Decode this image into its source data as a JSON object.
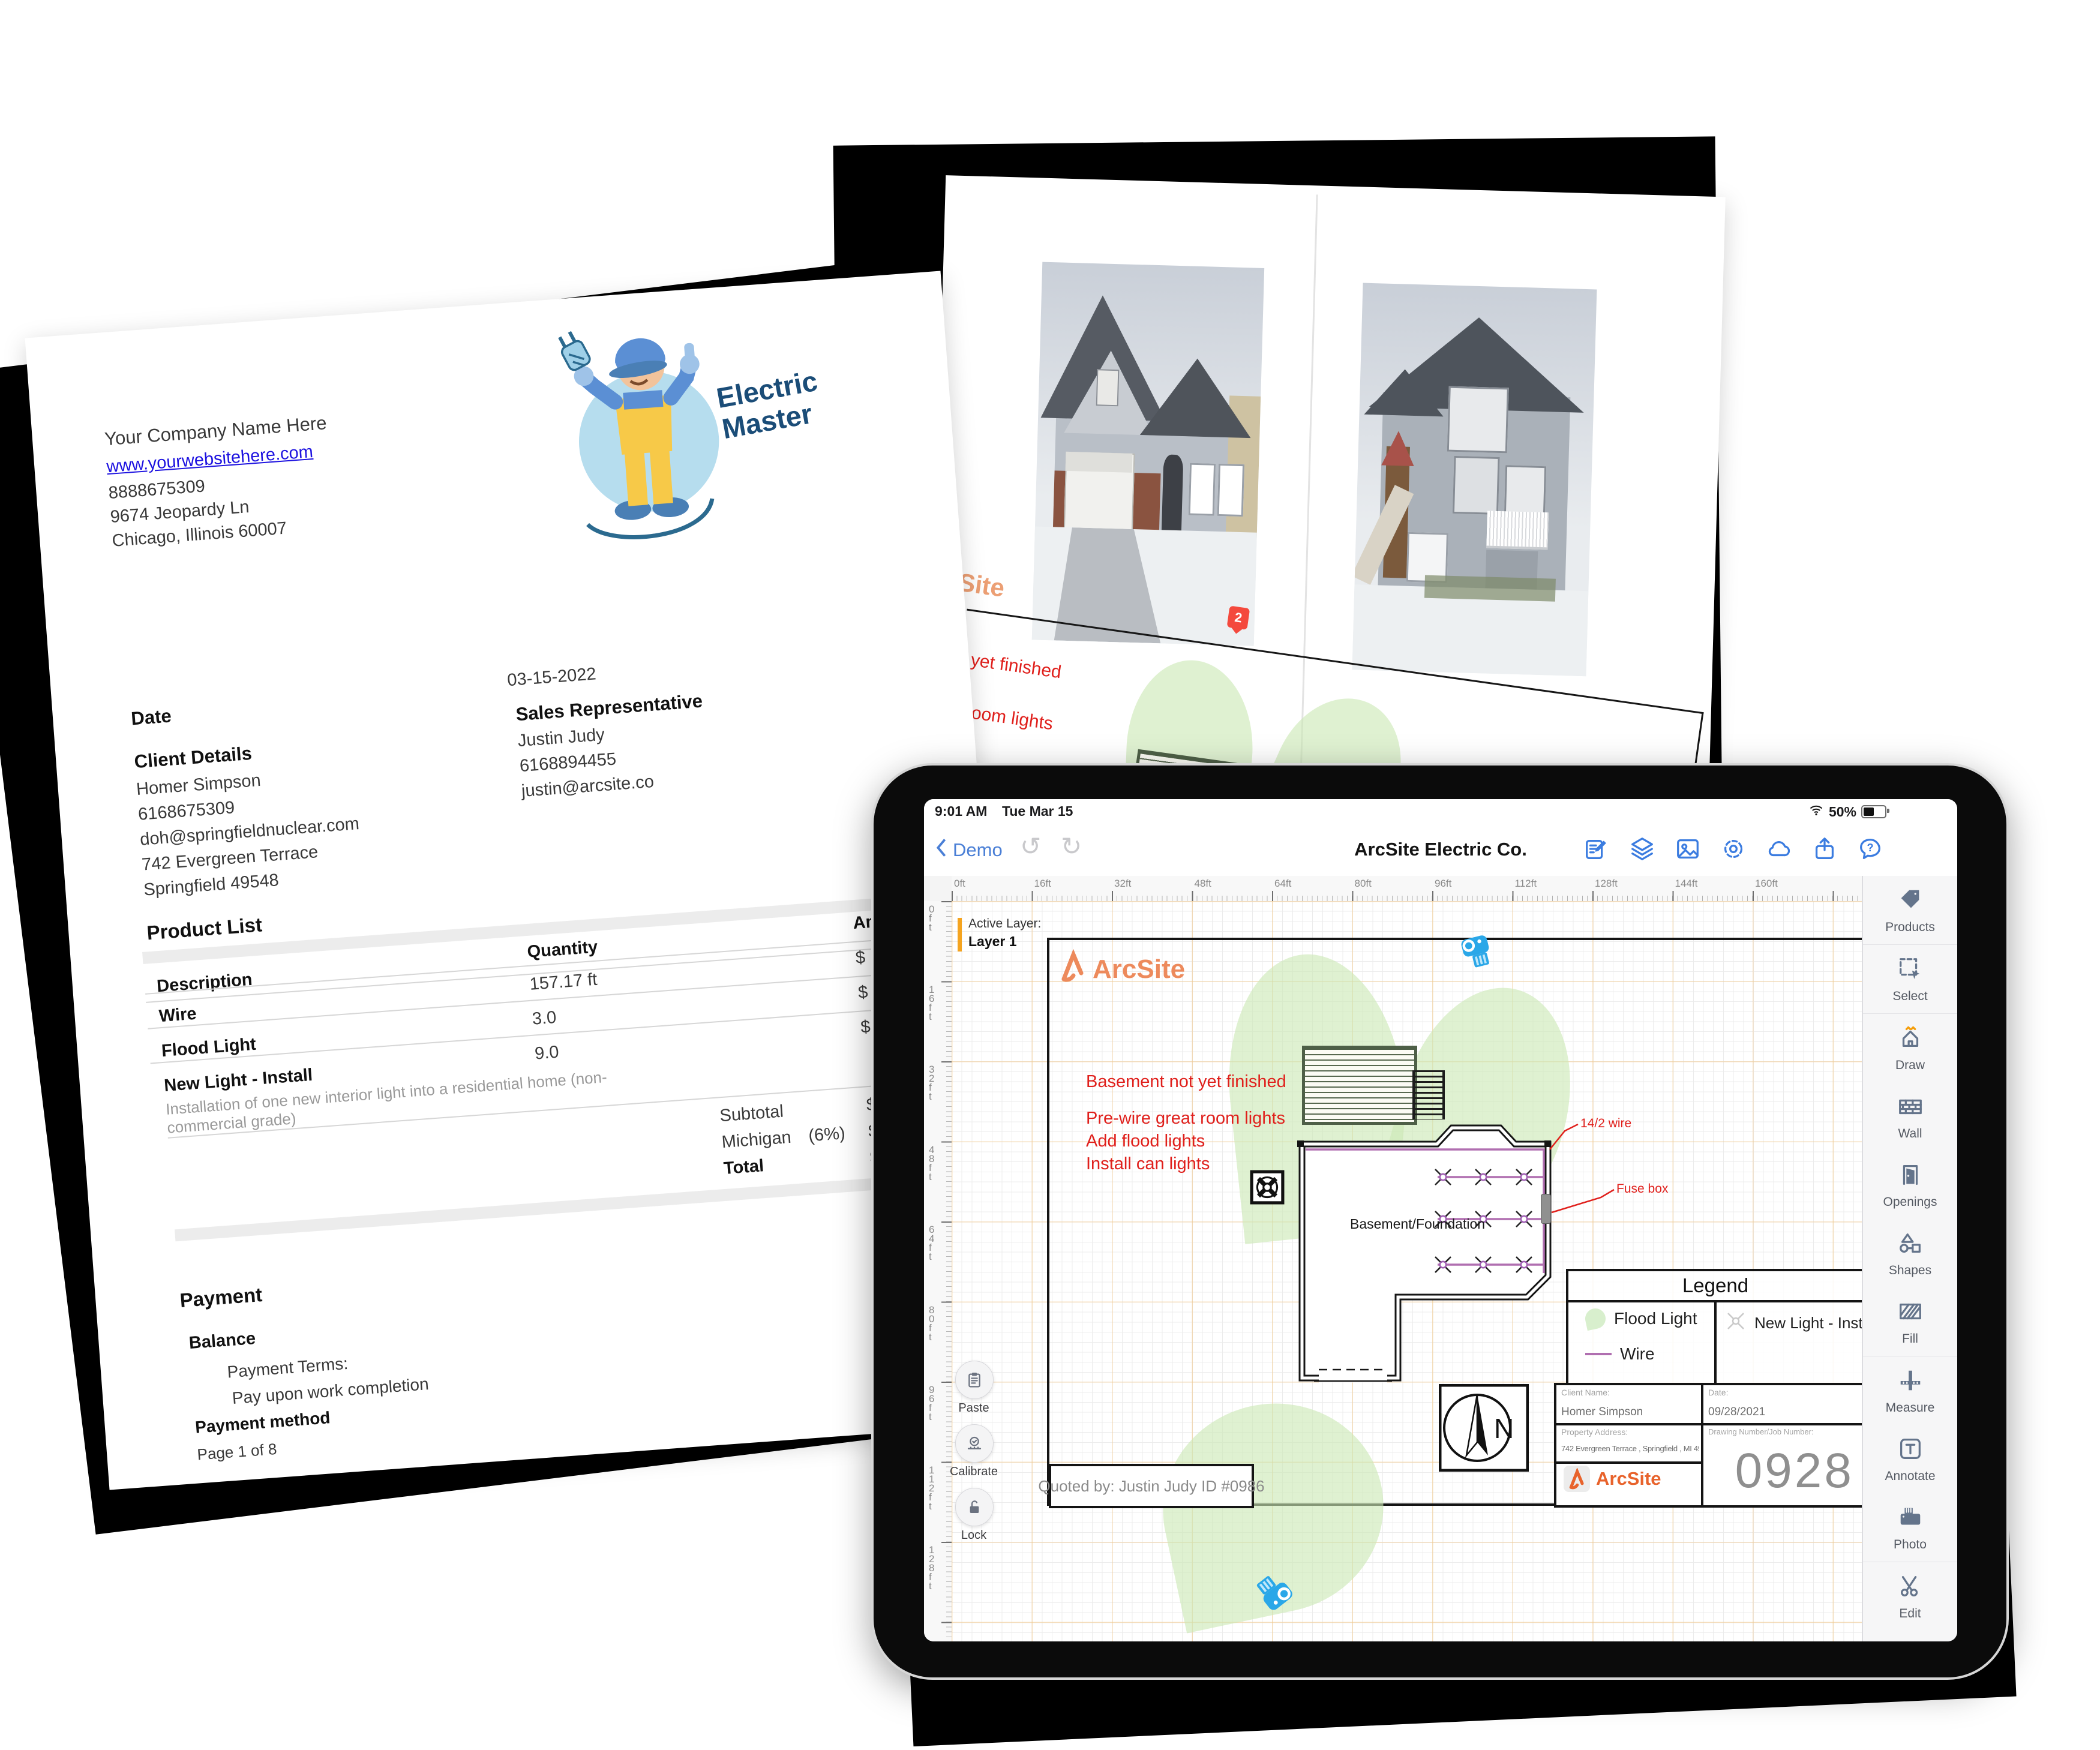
{
  "invoice": {
    "company": {
      "name": "Your Company Name Here",
      "website": "www.yourwebsitehere.com",
      "phone": "8888675309",
      "address1": "9674 Jeopardy Ln",
      "address2": "Chicago, Illinois 60007"
    },
    "logo": {
      "line1": "Electric",
      "line2": "Master"
    },
    "date_label": "Date",
    "date_value": "03-15-2022",
    "client": {
      "heading": "Client Details",
      "name": "Homer Simpson",
      "phone": "6168675309",
      "email": "doh@springfieldnuclear.com",
      "address1": "742 Evergreen Terrace",
      "address2": "Springfield 49548"
    },
    "sales_rep": {
      "heading": "Sales Representative",
      "name": "Justin Judy",
      "phone": "6168894455",
      "email": "justin@arcsite.co"
    },
    "product_list": {
      "heading": "Product List",
      "columns": [
        "Description",
        "Quantity",
        "Amount"
      ],
      "rows": [
        {
          "description": "Wire",
          "detail": "",
          "quantity": "157.17 ft",
          "amount": "$"
        },
        {
          "description": "Flood Light",
          "detail": "",
          "quantity": "3.0",
          "amount": "$"
        },
        {
          "description": "New Light - Install",
          "detail": "Installation of one new interior light into a residential home (non-commercial grade)",
          "quantity": "9.0",
          "amount": "$1"
        }
      ],
      "summary": [
        {
          "label": "Subtotal",
          "note": "",
          "amount": "$2"
        },
        {
          "label": "Michigan",
          "note": "(6%)",
          "amount": "$"
        },
        {
          "label": "Total",
          "note": "",
          "amount": "$3"
        }
      ]
    },
    "payment": {
      "heading": "Payment",
      "balance_label": "Balance",
      "terms_label": "Payment Terms:",
      "terms_value": "Pay upon work completion",
      "method_label": "Payment method"
    },
    "page_footer": "Page 1 of 8"
  },
  "photos_page": {
    "photo1_label": "1 - 1",
    "photo2_label": "2 - 1"
  },
  "plan_page": {
    "brand": "ArcSite",
    "pin_label": "2",
    "wire_label": "14/2 wire",
    "notes": [
      "Basement not yet finished",
      "Pre-wire great room lights",
      "Add flood lights",
      "Install can lights"
    ]
  },
  "tablet": {
    "status": {
      "time": "9:01 AM",
      "date": "Tue Mar 15",
      "battery": "50%"
    },
    "nav": {
      "back": "Demo",
      "title": "ArcSite Electric Co."
    },
    "nav_icons": [
      "compose-icon",
      "layers-icon",
      "image-icon",
      "settings-gear-icon",
      "cloud-icon",
      "share-icon",
      "help-chat-icon"
    ],
    "active_layer": {
      "label": "Active Layer:",
      "value": "Layer 1"
    },
    "ruler_h": [
      "0ft",
      "16ft",
      "32ft",
      "48ft",
      "64ft",
      "80ft",
      "96ft",
      "112ft",
      "128ft",
      "144ft",
      "160ft"
    ],
    "ruler_v": [
      "0ft",
      "16ft",
      "32ft",
      "48ft",
      "64ft",
      "80ft",
      "96ft",
      "112ft",
      "128ft"
    ],
    "sidebar": [
      {
        "label": "Products",
        "icon": "products-tag-icon"
      },
      {
        "label": "Select",
        "icon": "select-icon"
      },
      {
        "label": "Draw",
        "icon": "draw-house-icon"
      },
      {
        "label": "Wall",
        "icon": "wall-brick-icon"
      },
      {
        "label": "Openings",
        "icon": "door-opening-icon"
      },
      {
        "label": "Shapes",
        "icon": "shapes-icon"
      },
      {
        "label": "Fill",
        "icon": "fill-hatch-icon"
      },
      {
        "label": "Measure",
        "icon": "measure-ruler-icon"
      },
      {
        "label": "Annotate",
        "icon": "annotate-text-icon"
      },
      {
        "label": "Photo",
        "icon": "camera-icon"
      },
      {
        "label": "Edit",
        "icon": "scissors-icon"
      }
    ],
    "floating_buttons": [
      {
        "label": "Paste",
        "icon": "clipboard-icon"
      },
      {
        "label": "Calibrate",
        "icon": "calibrate-icon"
      },
      {
        "label": "Lock",
        "icon": "unlock-icon"
      }
    ],
    "drawing": {
      "brand": "ArcSite",
      "notes": [
        "Basement not yet finished",
        "Pre-wire great room lights",
        "Add flood lights",
        "Install can lights"
      ],
      "room_label": "Basement/Foundation",
      "wire_label": "14/2 wire",
      "fusebox_label": "Fuse box",
      "legend": {
        "title": "Legend",
        "flood": "Flood Light",
        "wire": "Wire",
        "newlight": "New Light - Install"
      },
      "title_block": {
        "client_label": "Client Name:",
        "client": "Homer Simpson",
        "date_label": "Date:",
        "date": "09/28/2021",
        "address_label": "Property Address:",
        "address": "742 Evergreen Terrace , Springfield , MI 49548",
        "number_label": "Drawing Number/Job Number:",
        "number": "0928",
        "brand": "ArcSite"
      },
      "quoted_by": "Quoted by: Justin Judy ID #0986",
      "compass": "N"
    },
    "accent_colors": {
      "ios_blue": "#4a7fd6",
      "arcsite_orange": "#e8632c",
      "annotation_red": "#e0201c",
      "wire_purple": "#b06fb0",
      "flood_green": "#d8efcd",
      "layer_orange": "#f5a41f"
    }
  }
}
